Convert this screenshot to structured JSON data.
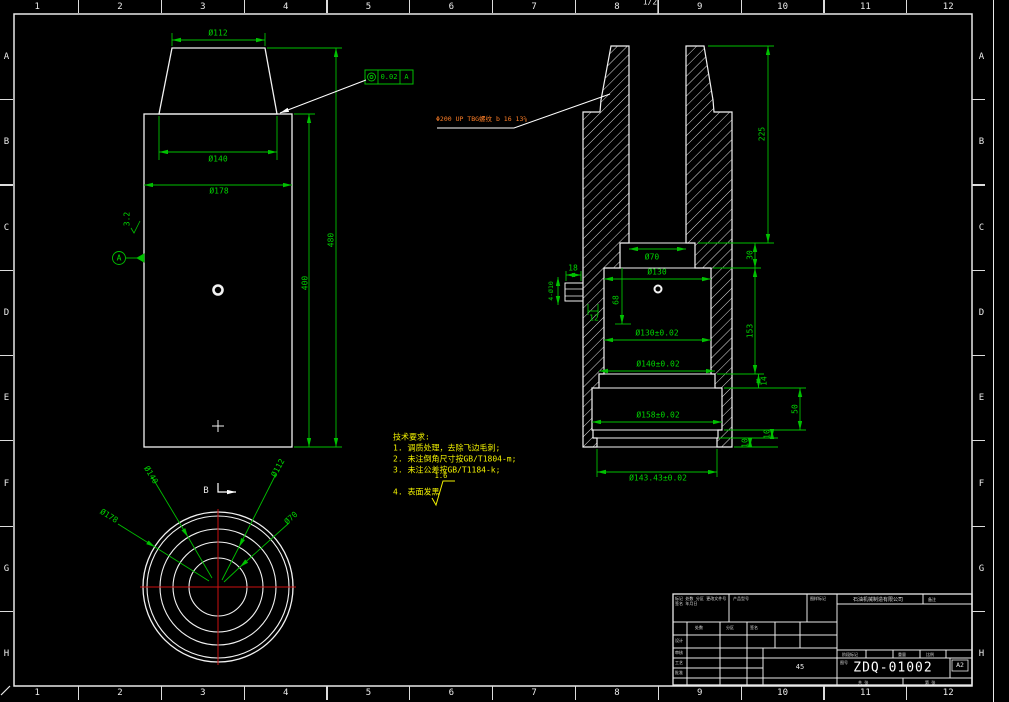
{
  "border": {
    "cols": [
      "1",
      "2",
      "3",
      "4",
      "5",
      "6",
      "7",
      "8",
      "9",
      "10",
      "11",
      "12"
    ],
    "rows": [
      "A",
      "B",
      "C",
      "D",
      "E",
      "F",
      "G",
      "H"
    ],
    "fold_label": "1/2"
  },
  "front_view": {
    "d112": "Ø112",
    "d140": "Ø140",
    "d178": "Ø178",
    "h400": "400",
    "h480": "480",
    "surface": "3.2",
    "datum": "A",
    "tol_value": "0.02",
    "tol_datum": "A"
  },
  "section_view": {
    "thread_note": "Φ200 UP TBG螺纹 b 16 13⅝",
    "d70": "Ø70",
    "d130": "Ø130",
    "d68": "68",
    "d130t": "Ø130±0.02",
    "d140t": "Ø140±0.02",
    "d158t": "Ø158±0.02",
    "d143t": "Ø143.43±0.02",
    "d18": "18",
    "d12": "12",
    "d4x10": "4-Ø10",
    "v225": "225",
    "v30": "30",
    "v153": "153",
    "v14": "14",
    "v50": "50",
    "v10a": "10",
    "v10b": "10"
  },
  "bottom_view": {
    "label": "B",
    "d140": "Ø140",
    "d178": "Ø178",
    "d112": "Ø112",
    "d70": "Ø70"
  },
  "notes": {
    "title": "技术要求:",
    "item1": "1. 调质处理，去除飞边毛刺;",
    "item2": "2. 未注倒角尺寸按GB/T1804-m;",
    "item3": "3. 未注公差按GB/T1184-k;",
    "item4": "4. 表面发黑",
    "surface_value": "1.6"
  },
  "title_block": {
    "drawing_number": "ZDQ-01002",
    "sheet_size": "A2",
    "material": "45",
    "rev_header": "标记 处数 分区 更改文件号 签名 年月日",
    "col_header1": "处数",
    "col_header2": "分区",
    "col_header3": "签名",
    "row_label1": "设计",
    "row_label2": "审核",
    "row_label3": "工艺",
    "row_label4": "批准",
    "cell_product": "产品型号",
    "cell_mark": "图样标记",
    "cell_note": "备注",
    "company": "石油机械制造有限公司",
    "stage_label1": "阶段标记",
    "stage_label2": "重量",
    "stage_label3": "比例",
    "dwg_label": "图号",
    "bottom_label1": "共 张",
    "bottom_label2": "第 张"
  }
}
